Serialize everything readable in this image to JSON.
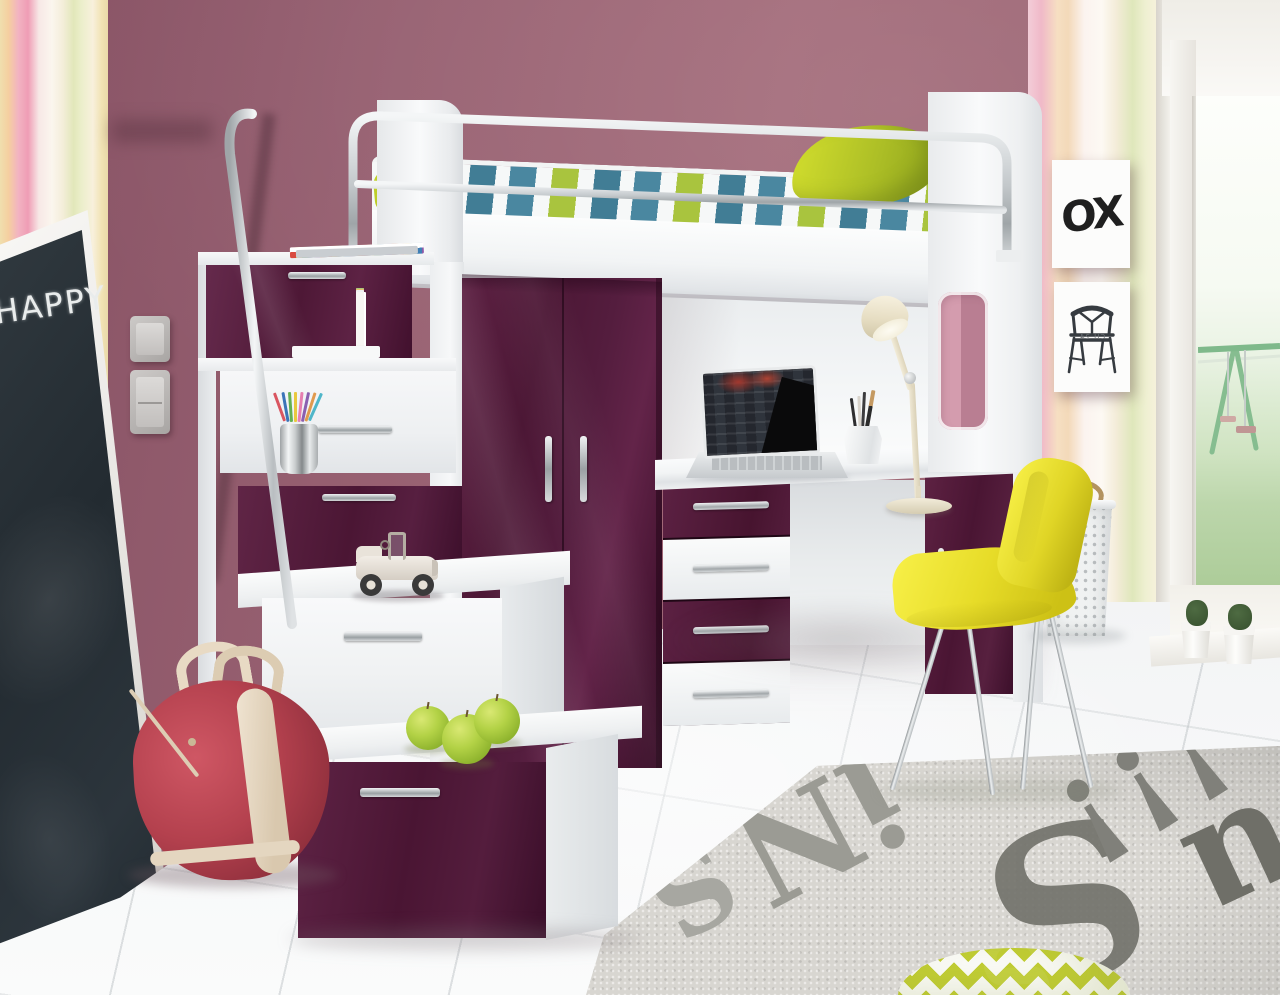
{
  "scene": {
    "name": "Kids room with purple-and-white loft bed, stair drawers, wardrobe and desk"
  },
  "palette": {
    "wall_mauve": "#9a6171",
    "wallpaper_pink": "#f2b3c2",
    "wallpaper_yellow": "#f1dfae",
    "wallpaper_green": "#e2e7ba",
    "furniture_purple": "#4c1735",
    "furniture_white": "#f4f5f6",
    "chrome": "#c3c8cb",
    "bedding_teal": "#4a87a0",
    "bedding_green": "#a9c43e",
    "pillow_lime": "#b3c427",
    "chair_yellow": "#e7dc28",
    "bag_red": "#b4414e",
    "bag_trim": "#e8dac4",
    "apple_green": "#a9c93c",
    "rug_base": "#d8d6d1",
    "rug_text": "#7b7b74",
    "floor_tile": "#eef0f1",
    "garden_green": "#abcb97"
  },
  "chalkboard": {
    "text": "HAPPY"
  },
  "posters": {
    "ox_text": "OX",
    "chair_caption": "CH 24"
  },
  "books": {
    "stack_main": "HELMUT NEWTON",
    "spine": "Colorindex"
  },
  "rug": {
    "letters": {
      "a": "S",
      "b": "iN",
      "c": "!!!",
      "d": "S",
      "e": "u"
    }
  }
}
